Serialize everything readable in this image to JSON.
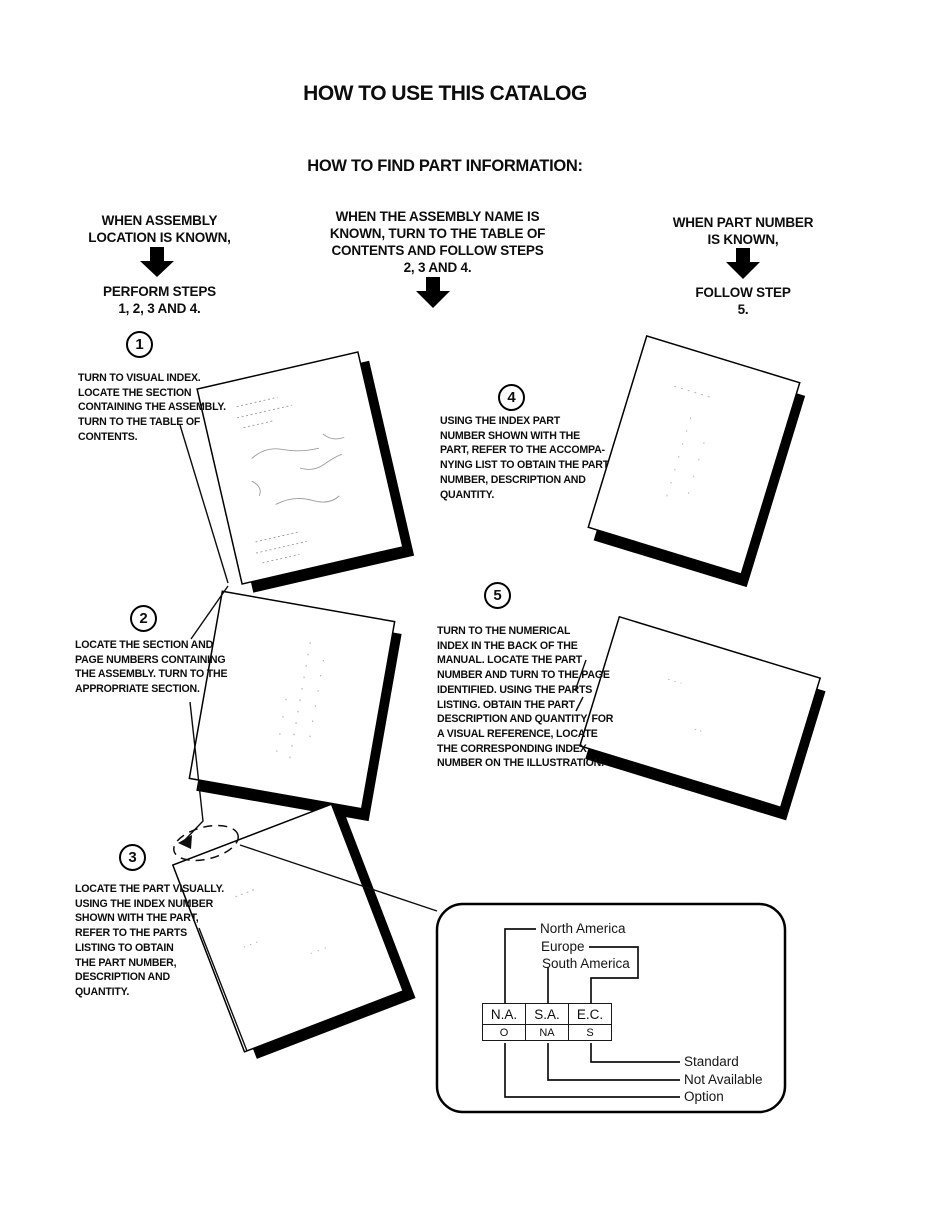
{
  "page": {
    "title": "HOW TO USE THIS CATALOG",
    "subtitle": "HOW TO FIND PART INFORMATION:"
  },
  "columns": [
    {
      "condition": "WHEN ASSEMBLY\nLOCATION IS KNOWN,",
      "action": "PERFORM STEPS\n1, 2, 3 AND 4."
    },
    {
      "condition": "WHEN THE ASSEMBLY NAME IS\nKNOWN, TURN TO THE TABLE OF\nCONTENTS AND FOLLOW STEPS\n2, 3 AND 4."
    },
    {
      "condition": "WHEN PART NUMBER\nIS KNOWN,",
      "action": "FOLLOW STEP\n5."
    }
  ],
  "steps": [
    {
      "number": "1",
      "text": "TURN TO VISUAL INDEX.\nLOCATE THE SECTION\nCONTAINING THE ASSEMBLY.\nTURN TO THE TABLE OF\nCONTENTS."
    },
    {
      "number": "2",
      "text": "LOCATE THE SECTION AND\nPAGE NUMBERS CONTAINING\nTHE ASSEMBLY. TURN TO THE\nAPPROPRIATE SECTION."
    },
    {
      "number": "3",
      "text": "LOCATE THE PART VISUALLY.\nUSING THE INDEX NUMBER\nSHOWN WITH THE PART,\nREFER TO THE PARTS\nLISTING TO OBTAIN\nTHE PART NUMBER,\nDESCRIPTION AND\nQUANTITY."
    },
    {
      "number": "4",
      "text": "USING THE INDEX PART\nNUMBER SHOWN WITH THE\nPART, REFER TO THE ACCOMPA-\nNYING LIST TO OBTAIN THE PART\nNUMBER, DESCRIPTION AND\nQUANTITY."
    },
    {
      "number": "5",
      "text": "TURN TO THE NUMERICAL\nINDEX IN THE BACK OF THE\nMANUAL. LOCATE THE PART\nNUMBER AND TURN TO THE PAGE\nIDENTIFIED. USING THE PARTS\nLISTING. OBTAIN THE PART\nDESCRIPTION AND QUANTITY. FOR\nA VISUAL REFERENCE, LOCATE\nTHE CORRESPONDING INDEX\nNUMBER ON THE ILLUSTRATION."
    }
  ],
  "legend": {
    "regions": [
      "North America",
      "Europe",
      "South America"
    ],
    "table": {
      "headers": [
        "N.A.",
        "S.A.",
        "E.C."
      ],
      "values": [
        "O",
        "NA",
        "S"
      ]
    },
    "codes": [
      "Standard",
      "Not Available",
      "Option"
    ]
  },
  "colors": {
    "ink": "#000000",
    "paper": "#ffffff"
  }
}
